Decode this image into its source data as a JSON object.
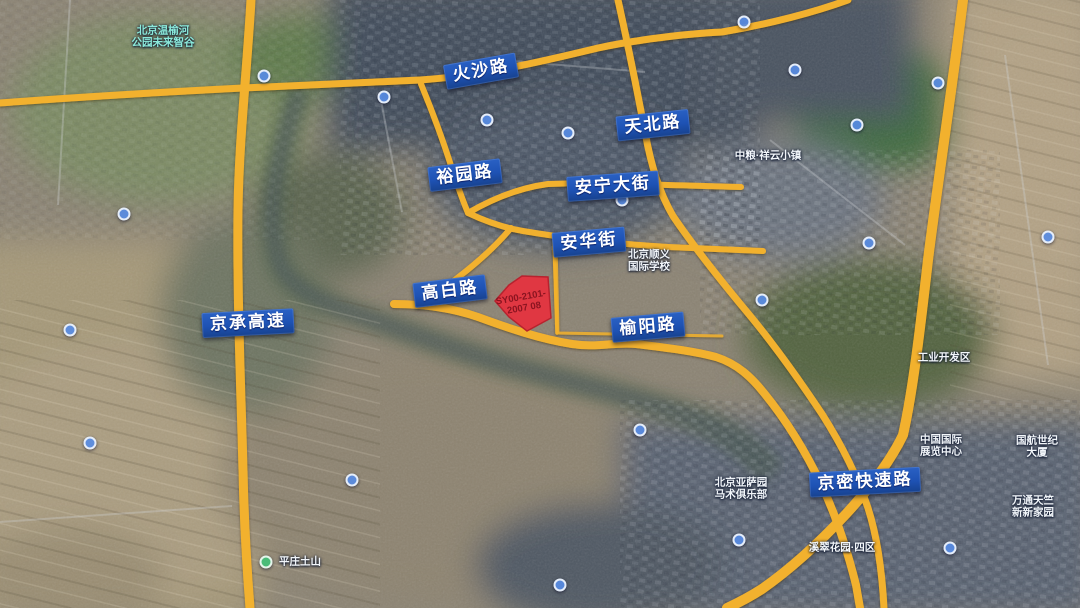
{
  "colors": {
    "road_yellow": "#f2b12d",
    "label_blue": "#1e52b4",
    "label_text": "#ffffff",
    "parcel_red": "#e43440",
    "parcel_text": "#8a1420",
    "poi_teal": "#8ceadb",
    "poi_white": "#f2f6fa"
  },
  "road_labels": [
    {
      "id": "huosha-road",
      "text": "火沙路",
      "x": 481,
      "y": 71,
      "rotate": -10
    },
    {
      "id": "tianbei-road",
      "text": "天北路",
      "x": 653,
      "y": 125,
      "rotate": -6
    },
    {
      "id": "yuyuan-road",
      "text": "裕园路",
      "x": 465,
      "y": 175,
      "rotate": -7
    },
    {
      "id": "anning-avenue",
      "text": "安宁大街",
      "x": 613,
      "y": 186,
      "rotate": -4
    },
    {
      "id": "anhua-street",
      "text": "安华街",
      "x": 589,
      "y": 242,
      "rotate": -5
    },
    {
      "id": "gaobai-road",
      "text": "高白路",
      "x": 450,
      "y": 291,
      "rotate": -7
    },
    {
      "id": "jingcheng-expressway",
      "text": "京承高速",
      "x": 248,
      "y": 323,
      "rotate": -3
    },
    {
      "id": "yuyang-road",
      "text": "榆阳路",
      "x": 648,
      "y": 327,
      "rotate": -5
    },
    {
      "id": "jingmi-expressway",
      "text": "京密快速路",
      "x": 865,
      "y": 482,
      "rotate": -3
    }
  ],
  "parcel": {
    "code_line1": "SY00-2101-",
    "code_line2": "2007 08"
  },
  "poi_labels": [
    {
      "id": "wenyuhe-park",
      "lines": [
        "北京温榆河",
        "公园未来智谷"
      ],
      "x": 163,
      "y": 37,
      "color": "teal"
    },
    {
      "id": "xiangyun-town",
      "lines": [
        "中粮·祥云小镇"
      ],
      "x": 768,
      "y": 156,
      "color": "white"
    },
    {
      "id": "shunyi-intl-school",
      "lines": [
        "北京顺义",
        "国际学校"
      ],
      "x": 649,
      "y": 261,
      "color": "white"
    },
    {
      "id": "china-intl-exhibition",
      "lines": [
        "中国国际",
        "展览中心"
      ],
      "x": 941,
      "y": 446,
      "color": "white"
    },
    {
      "id": "guohang-tower",
      "lines": [
        "国航世纪大厦"
      ],
      "x": 1037,
      "y": 447,
      "color": "white"
    },
    {
      "id": "wantong-home",
      "lines": [
        "万通天竺",
        "新新家园"
      ],
      "x": 1033,
      "y": 507,
      "color": "white"
    },
    {
      "id": "equestrian-club",
      "lines": [
        "北京亚萨园",
        "马术俱乐部"
      ],
      "x": 741,
      "y": 489,
      "color": "white"
    },
    {
      "id": "xicui-garden",
      "lines": [
        "溪翠花园·四区"
      ],
      "x": 842,
      "y": 548,
      "color": "white"
    },
    {
      "id": "pingzhuang-hill",
      "lines": [
        "平庄土山"
      ],
      "x": 300,
      "y": 562,
      "color": "white"
    },
    {
      "id": "industrial-zone",
      "lines": [
        "工业开发区"
      ],
      "x": 944,
      "y": 358,
      "color": "white"
    }
  ],
  "poi_dots": [
    {
      "x": 264,
      "y": 76,
      "color": "blue"
    },
    {
      "x": 384,
      "y": 97,
      "color": "blue"
    },
    {
      "x": 124,
      "y": 214,
      "color": "blue"
    },
    {
      "x": 487,
      "y": 120,
      "color": "blue"
    },
    {
      "x": 568,
      "y": 133,
      "color": "blue"
    },
    {
      "x": 622,
      "y": 200,
      "color": "blue"
    },
    {
      "x": 744,
      "y": 22,
      "color": "blue"
    },
    {
      "x": 795,
      "y": 70,
      "color": "blue"
    },
    {
      "x": 857,
      "y": 125,
      "color": "blue"
    },
    {
      "x": 938,
      "y": 83,
      "color": "blue"
    },
    {
      "x": 762,
      "y": 300,
      "color": "blue"
    },
    {
      "x": 869,
      "y": 243,
      "color": "blue"
    },
    {
      "x": 640,
      "y": 430,
      "color": "blue"
    },
    {
      "x": 739,
      "y": 540,
      "color": "blue"
    },
    {
      "x": 352,
      "y": 480,
      "color": "blue"
    },
    {
      "x": 560,
      "y": 585,
      "color": "blue"
    },
    {
      "x": 950,
      "y": 548,
      "color": "blue"
    },
    {
      "x": 1048,
      "y": 237,
      "color": "blue"
    },
    {
      "x": 90,
      "y": 443,
      "color": "blue"
    },
    {
      "x": 70,
      "y": 330,
      "color": "blue"
    },
    {
      "x": 266,
      "y": 562,
      "color": "green"
    }
  ]
}
